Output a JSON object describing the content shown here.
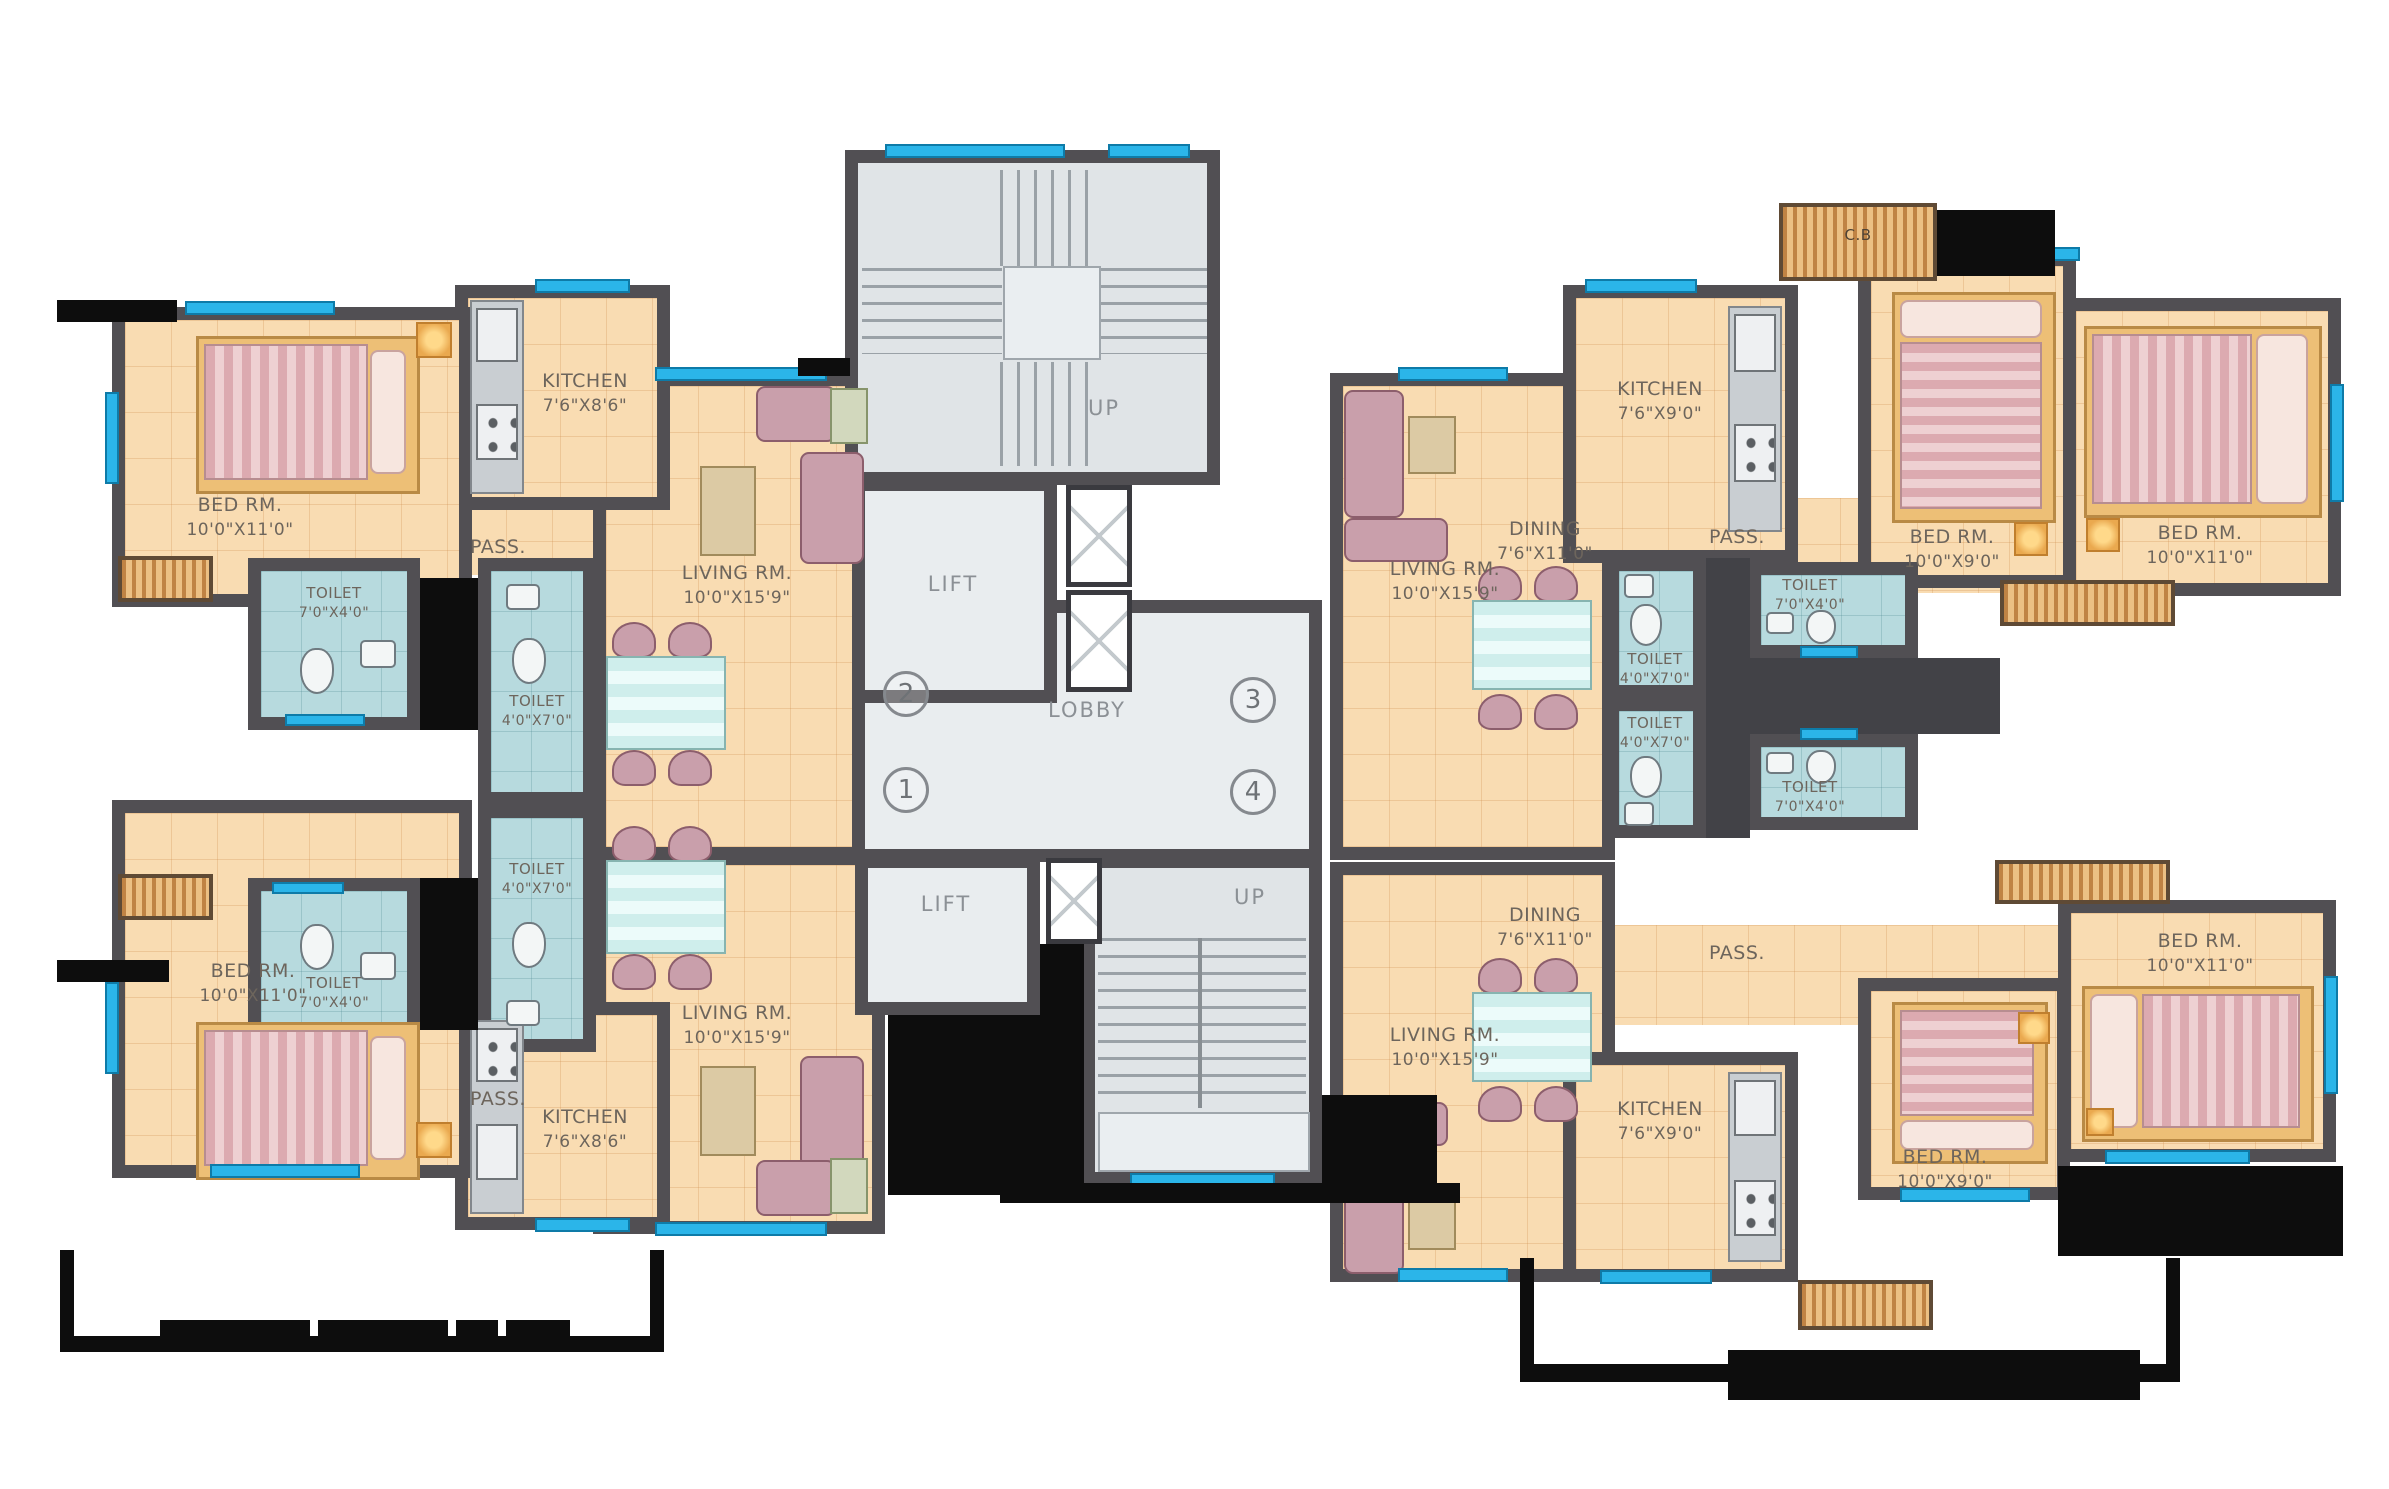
{
  "core": {
    "up_top": "UP",
    "up_bottom": "UP",
    "lift_top": "LIFT",
    "lift_bottom": "LIFT",
    "lobby": "LOBBY",
    "flat_numbers": {
      "n1": "1",
      "n2": "2",
      "n3": "3",
      "n4": "4"
    }
  },
  "flat2": {
    "bed": {
      "name": "BED RM.",
      "dim": "10'0\"X11'0\""
    },
    "kitchen": {
      "name": "KITCHEN",
      "dim": "7'6\"X8'6\""
    },
    "pass": "PASS.",
    "toilet_main": {
      "name": "TOILET",
      "dim": "7'0\"X4'0\""
    },
    "toilet_small": {
      "name": "TOILET",
      "dim": "4'0\"X7'0\""
    },
    "living": {
      "name": "LIVING RM.",
      "dim": "10'0\"X15'9\""
    }
  },
  "flat1": {
    "bed": {
      "name": "BED RM.",
      "dim": "10'0\"X11'0\""
    },
    "kitchen": {
      "name": "KITCHEN",
      "dim": "7'6\"X8'6\""
    },
    "pass": "PASS.",
    "toilet_main": {
      "name": "TOILET",
      "dim": "7'0\"X4'0\""
    },
    "toilet_small": {
      "name": "TOILET",
      "dim": "4'0\"X7'0\""
    },
    "living": {
      "name": "LIVING RM.",
      "dim": "10'0\"X15'9\""
    }
  },
  "flat3": {
    "kitchen": {
      "name": "KITCHEN",
      "dim": "7'6\"X9'0\""
    },
    "cupboard": "C.B",
    "bed_a": {
      "name": "BED RM.",
      "dim": "10'0\"X9'0\""
    },
    "bed_b": {
      "name": "BED RM.",
      "dim": "10'0\"X11'0\""
    },
    "pass": "PASS.",
    "dining": {
      "name": "DINING",
      "dim": "7'6\"X11'0\""
    },
    "living": {
      "name": "LIVING RM.",
      "dim": "10'0\"X15'9\""
    },
    "toilet_main": {
      "name": "TOILET",
      "dim": "7'0\"X4'0\""
    },
    "toilet_small": {
      "name": "TOILET",
      "dim": "4'0\"X7'0\""
    }
  },
  "flat4": {
    "kitchen": {
      "name": "KITCHEN",
      "dim": "7'6\"X9'0\""
    },
    "bed_a": {
      "name": "BED RM.",
      "dim": "10'0\"X9'0\""
    },
    "bed_b": {
      "name": "BED RM.",
      "dim": "10'0\"X11'0\""
    },
    "pass": "PASS.",
    "dining": {
      "name": "DINING",
      "dim": "7'6\"X11'0\""
    },
    "living": {
      "name": "LIVING RM.",
      "dim": "10'0\"X15'9\""
    },
    "toilet_main": {
      "name": "TOILET",
      "dim": "7'0\"X4'0\""
    },
    "toilet_small": {
      "name": "TOILET",
      "dim": "4'0\"X7'0\""
    }
  }
}
